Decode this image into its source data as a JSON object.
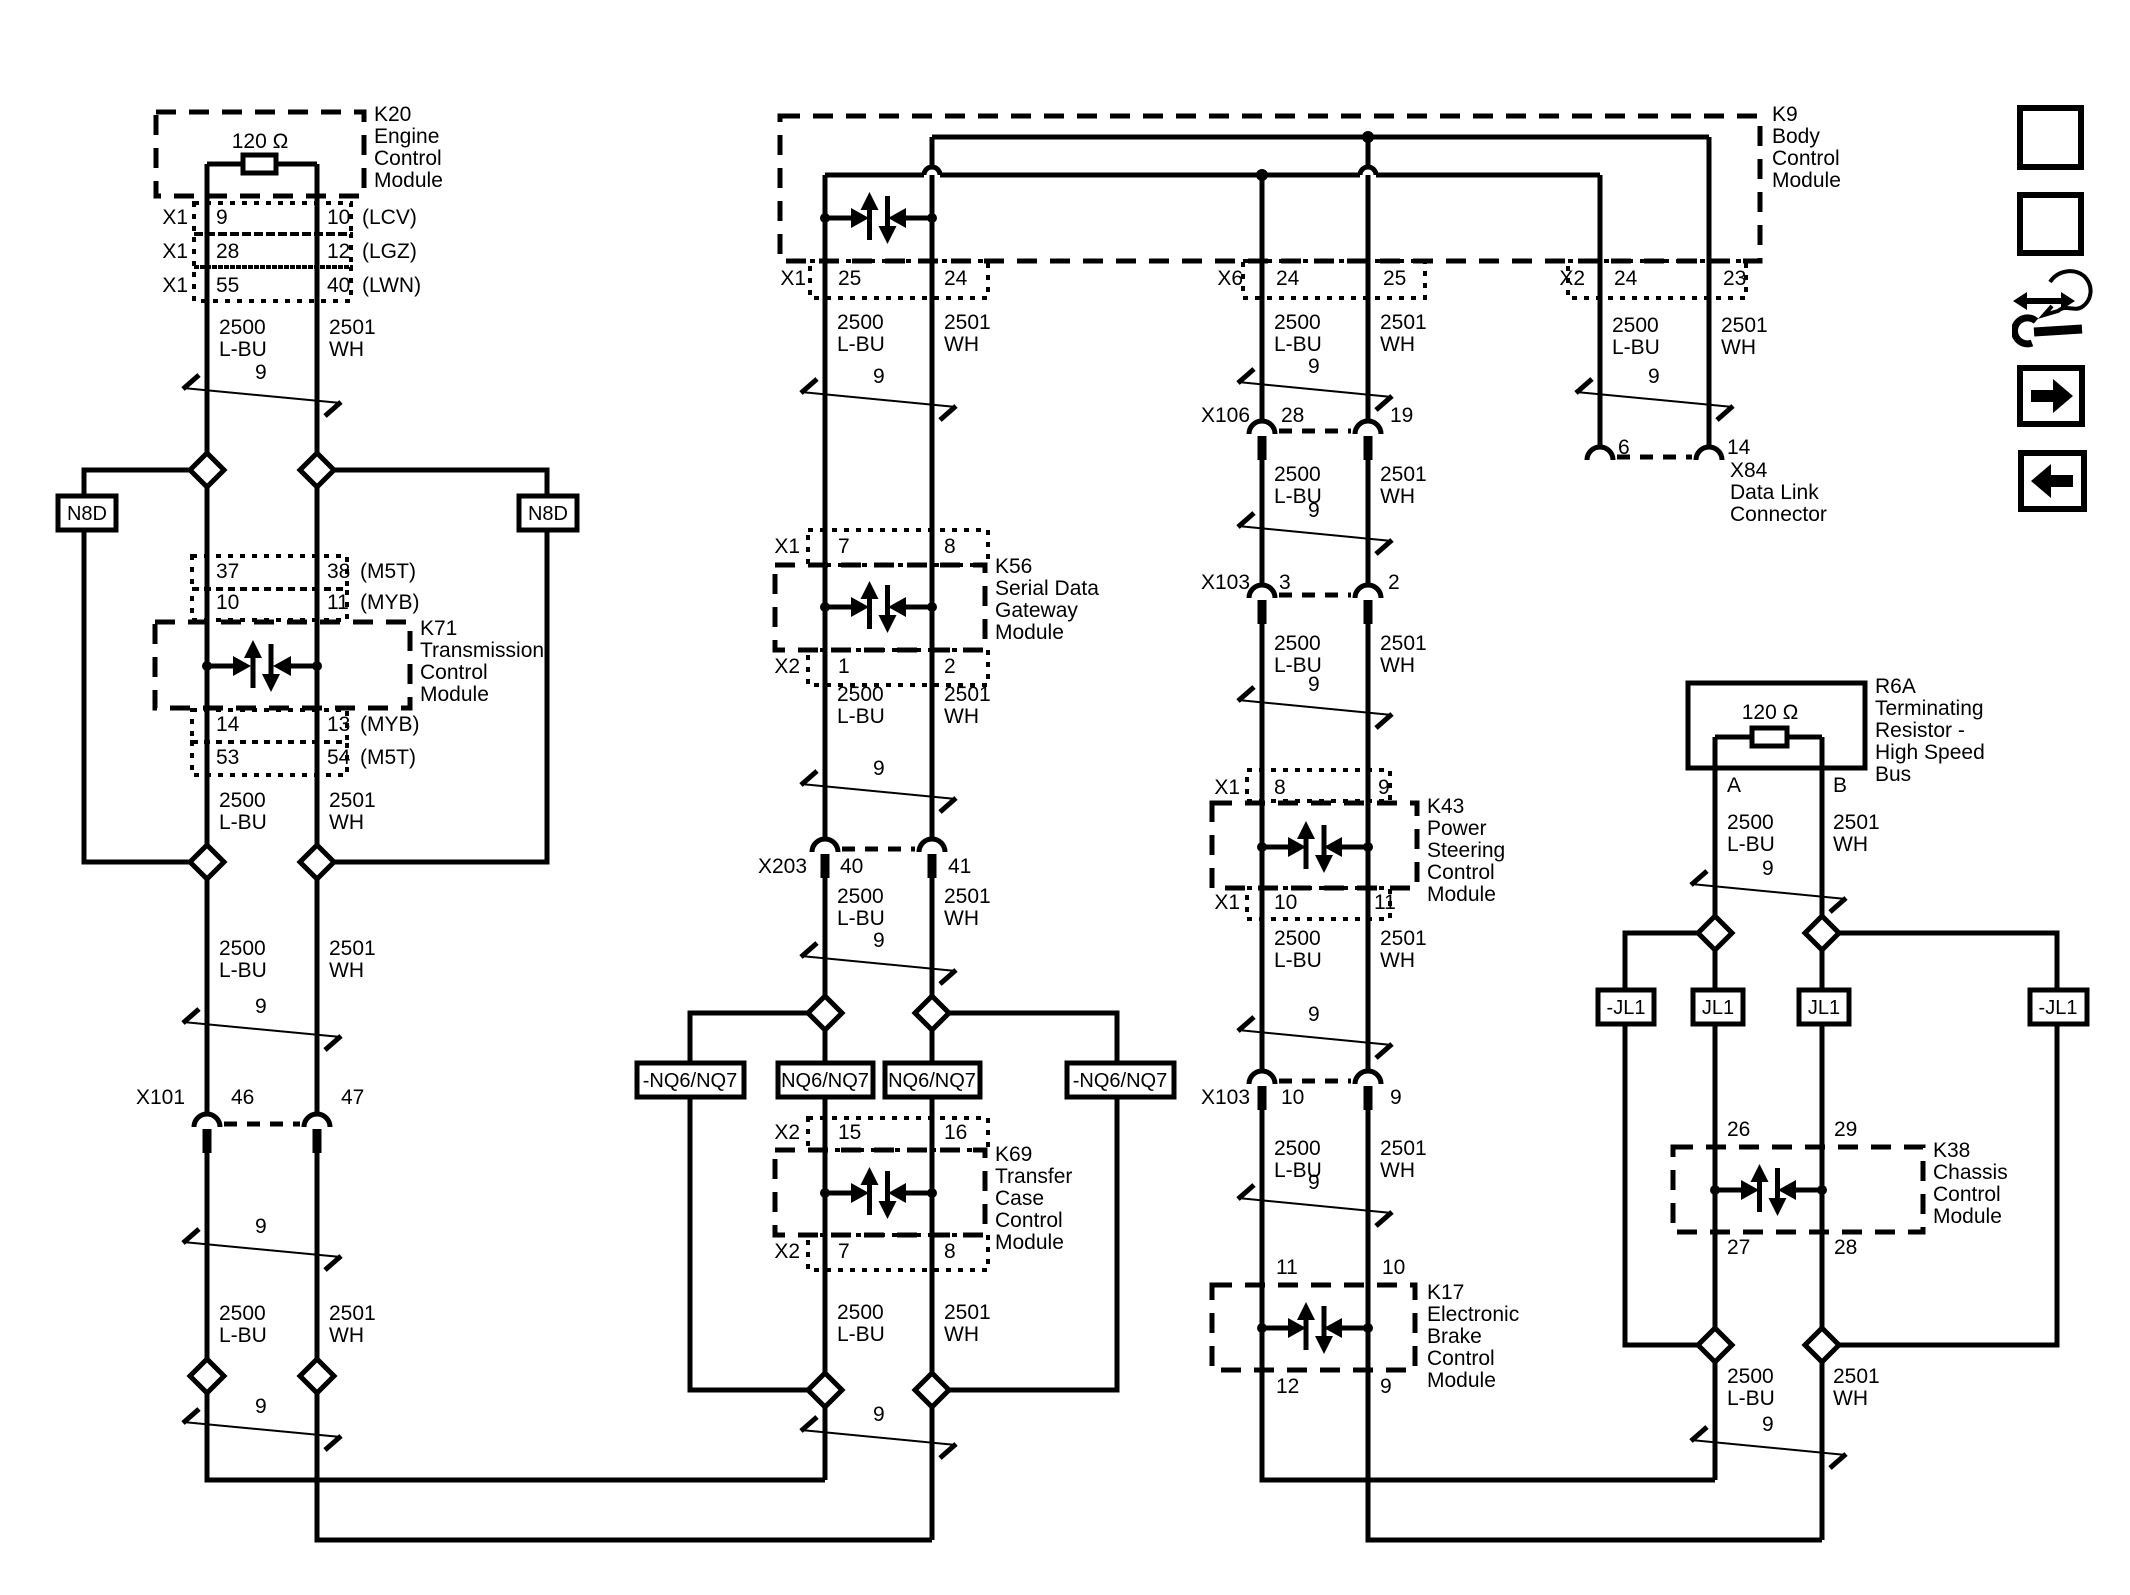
{
  "wire_labels": {
    "high": "2500\nL-BU",
    "low": "2501\nWH",
    "twist": "9"
  },
  "resistor_value": "120 Ω",
  "modules": {
    "k20": {
      "code": "K20",
      "name": "Engine\nControl\nModule",
      "pins": [
        {
          "conn": "X1",
          "l": "9",
          "r": "10",
          "opt": "(LCV)"
        },
        {
          "conn": "X1",
          "l": "28",
          "r": "12",
          "opt": "(LGZ)"
        },
        {
          "conn": "X1",
          "l": "55",
          "r": "40",
          "opt": "(LWN)"
        }
      ]
    },
    "k71": {
      "code": "K71",
      "name": "Transmission\nControl\nModule",
      "pins_top": [
        {
          "l": "37",
          "r": "38",
          "opt": "(M5T)"
        },
        {
          "l": "10",
          "r": "11",
          "opt": "(MYB)"
        }
      ],
      "pins_bottom": [
        {
          "l": "14",
          "r": "13",
          "opt": "(MYB)"
        },
        {
          "l": "53",
          "r": "54",
          "opt": "(M5T)"
        }
      ]
    },
    "k9": {
      "code": "K9",
      "name": "Body\nControl\nModule",
      "pins": [
        {
          "conn": "X1",
          "l": "25",
          "r": "24"
        },
        {
          "conn": "X6",
          "l": "24",
          "r": "25"
        },
        {
          "conn": "X2",
          "l": "24",
          "r": "23"
        }
      ]
    },
    "k56": {
      "code": "K56",
      "name": "Serial Data\nGateway\nModule",
      "pins_top": {
        "conn": "X1",
        "l": "7",
        "r": "8"
      },
      "pins_bottom": {
        "conn": "X2",
        "l": "1",
        "r": "2"
      }
    },
    "k69": {
      "code": "K69",
      "name": "Transfer\nCase\nControl\nModule",
      "pins_top": {
        "conn": "X2",
        "l": "15",
        "r": "16"
      },
      "pins_bottom": {
        "conn": "X2",
        "l": "7",
        "r": "8"
      }
    },
    "k43": {
      "code": "K43",
      "name": "Power\nSteering\nControl\nModule",
      "pins_top": {
        "conn": "X1",
        "l": "8",
        "r": "9"
      },
      "pins_bottom": {
        "conn": "X1",
        "l": "10",
        "r": "11"
      }
    },
    "k17": {
      "code": "K17",
      "name": "Electronic\nBrake\nControl\nModule",
      "pins_top": {
        "l": "11",
        "r": "10"
      },
      "pins_bottom": {
        "l": "12",
        "r": "9"
      }
    },
    "k38": {
      "code": "K38",
      "name": "Chassis\nControl\nModule",
      "pins_top": {
        "l": "26",
        "r": "29"
      },
      "pins_bottom": {
        "l": "27",
        "r": "28"
      }
    },
    "r6a": {
      "code": "R6A",
      "name": "Terminating\nResistor -\nHigh Speed\nBus",
      "pins": {
        "l": "A",
        "r": "B"
      }
    },
    "x84": {
      "code": "X84",
      "name": "Data Link\nConnector",
      "pins": {
        "l": "6",
        "r": "14"
      }
    }
  },
  "inline_connectors": {
    "x101": {
      "code": "X101",
      "l": "46",
      "r": "47"
    },
    "x203": {
      "code": "X203",
      "l": "40",
      "r": "41"
    },
    "x106": {
      "code": "X106",
      "l": "28",
      "r": "19"
    },
    "x103a": {
      "code": "X103",
      "l": "3",
      "r": "2"
    },
    "x103b": {
      "code": "X103",
      "l": "10",
      "r": "9"
    }
  },
  "option_tags": {
    "n8d": "N8D",
    "nq": [
      "-NQ6/NQ7",
      "NQ6/NQ7",
      "NQ6/NQ7",
      "-NQ6/NQ7"
    ],
    "jl": [
      "-JL1",
      "JL1",
      "JL1",
      "-JL1"
    ]
  },
  "toolbar": {
    "loc": [
      "L",
      "O",
      "C"
    ],
    "desc": [
      "D",
      "E",
      "S",
      "C"
    ]
  },
  "colors": {
    "line": "#000000",
    "background": "#ffffff"
  }
}
